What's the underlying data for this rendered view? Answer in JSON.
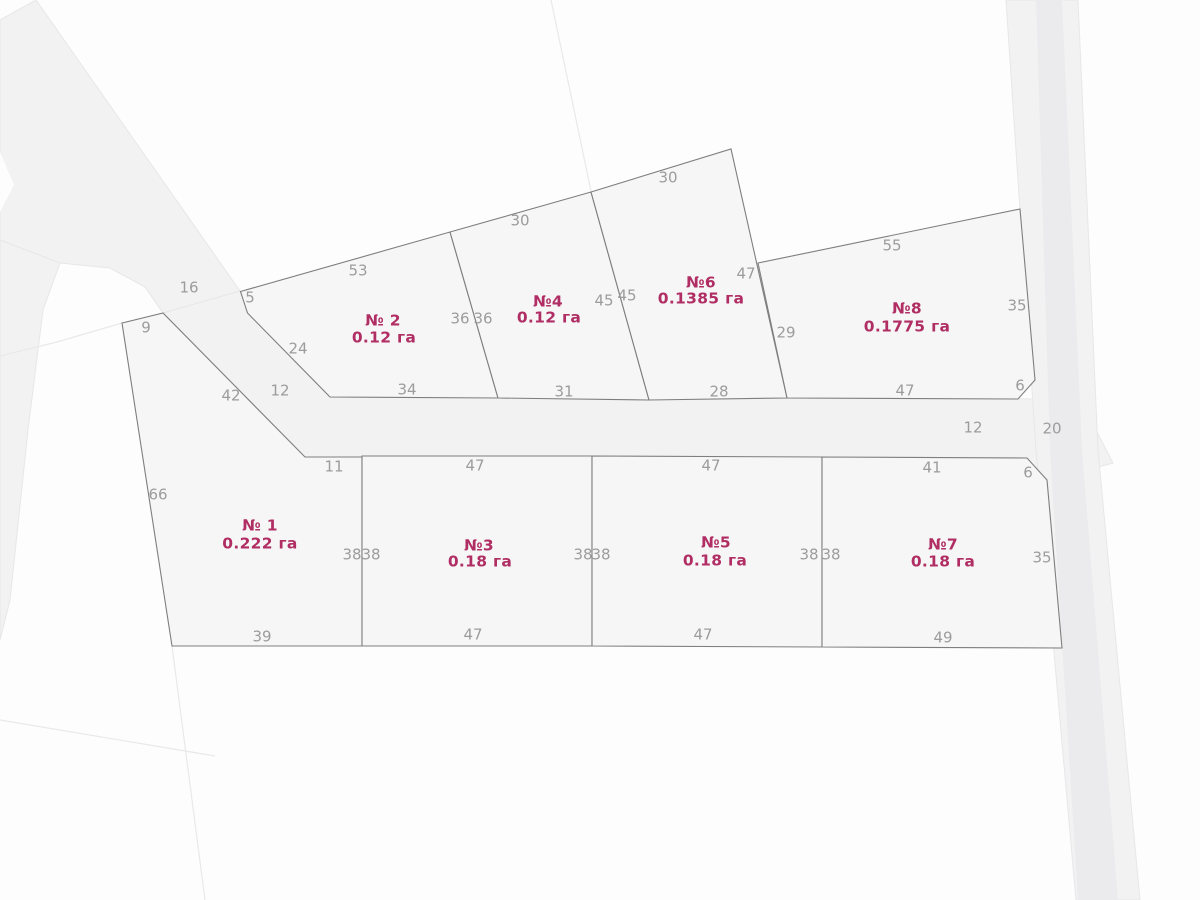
{
  "canvas": {
    "width": 1200,
    "height": 900
  },
  "colors": {
    "page": "#fdfdfd",
    "road_fill": "#f2f2f3",
    "road_stroke": "#e7e7e9",
    "road_inner_fill": "#ebebed",
    "plot_fill": "#f6f6f7",
    "plot_stroke": "#7e7e7e",
    "faint_line": "#e9e9eb",
    "edge_label": "#9c9c9c",
    "plot_label": "#b02e63"
  },
  "roads": [
    {
      "name": "road-northwest-diagonal",
      "points": [
        [
          36,
          0
        ],
        [
          240,
          291
        ],
        [
          163,
          313
        ],
        [
          145,
          287
        ],
        [
          110,
          268
        ],
        [
          60,
          263
        ],
        [
          0,
          240
        ],
        [
          0,
          20
        ]
      ]
    },
    {
      "name": "road-west-branch",
      "points": [
        [
          0,
          240
        ],
        [
          60,
          263
        ],
        [
          43,
          310
        ],
        [
          28,
          430
        ],
        [
          10,
          600
        ],
        [
          0,
          640
        ]
      ]
    },
    {
      "name": "road-central-horizontal",
      "points": [
        [
          240,
          291
        ],
        [
          248,
          313
        ],
        [
          330,
          397
        ],
        [
          1080,
          399
        ],
        [
          1113,
          463
        ],
        [
          1047,
          481
        ],
        [
          1027,
          458
        ],
        [
          362,
          457
        ],
        [
          305,
          457
        ],
        [
          163,
          313
        ]
      ]
    },
    {
      "name": "road-east-vertical",
      "points": [
        [
          1006,
          0
        ],
        [
          1078,
          0
        ],
        [
          1098,
          450
        ],
        [
          1140,
          900
        ],
        [
          1076,
          900
        ],
        [
          1036,
          450
        ]
      ]
    }
  ],
  "road_inner_strips": [
    {
      "name": "road-east-inner-strip",
      "points": [
        [
          1036,
          0
        ],
        [
          1062,
          0
        ],
        [
          1082,
          450
        ],
        [
          1118,
          900
        ],
        [
          1078,
          900
        ],
        [
          1050,
          450
        ]
      ]
    }
  ],
  "road_medians": [
    {
      "name": "road-median-island",
      "points": [
        [
          0,
          152
        ],
        [
          14,
          185
        ],
        [
          0,
          212
        ]
      ]
    }
  ],
  "boundary_lines": [
    {
      "name": "faint-boundary-north",
      "points": [
        [
          551,
          0
        ],
        [
          591,
          191
        ]
      ]
    },
    {
      "name": "faint-boundary-southwest-diagonal",
      "points": [
        [
          0,
          720
        ],
        [
          215,
          756
        ]
      ]
    },
    {
      "name": "faint-boundary-south-vertical",
      "points": [
        [
          172,
          646
        ],
        [
          205,
          900
        ]
      ]
    },
    {
      "name": "faint-boundary-west",
      "points": [
        [
          122,
          323
        ],
        [
          57,
          342
        ],
        [
          0,
          356
        ]
      ]
    }
  ],
  "plots": [
    {
      "id": "1",
      "number": "№ 1",
      "area": "0.222 га",
      "number_pos": [
        260,
        526
      ],
      "area_pos": [
        260,
        544
      ],
      "points": [
        [
          122,
          323
        ],
        [
          163,
          313
        ],
        [
          305,
          457
        ],
        [
          362,
          457
        ],
        [
          362,
          646
        ],
        [
          172,
          646
        ]
      ]
    },
    {
      "id": "2",
      "number": "№ 2",
      "area": "0.12 га",
      "number_pos": [
        383,
        321
      ],
      "area_pos": [
        384,
        338
      ],
      "points": [
        [
          240.5,
          291.5
        ],
        [
          450,
          232
        ],
        [
          498,
          398
        ],
        [
          330,
          397
        ],
        [
          247.5,
          313
        ]
      ]
    },
    {
      "id": "3",
      "number": "№3",
      "area": "0.18 га",
      "number_pos": [
        479,
        546
      ],
      "area_pos": [
        480,
        562
      ],
      "points": [
        [
          362,
          456
        ],
        [
          592,
          456
        ],
        [
          592,
          646
        ],
        [
          362,
          646
        ]
      ]
    },
    {
      "id": "4",
      "number": "№4",
      "area": "0.12 га",
      "number_pos": [
        548,
        302
      ],
      "area_pos": [
        549,
        318
      ],
      "points": [
        [
          450,
          232
        ],
        [
          591,
          192
        ],
        [
          649,
          400
        ],
        [
          498,
          398
        ]
      ]
    },
    {
      "id": "5",
      "number": "№5",
      "area": "0.18 га",
      "number_pos": [
        716,
        543
      ],
      "area_pos": [
        715,
        561
      ],
      "points": [
        [
          592,
          456
        ],
        [
          822,
          457
        ],
        [
          822,
          647
        ],
        [
          592,
          646
        ]
      ]
    },
    {
      "id": "6",
      "number": "№6",
      "area": "0.1385 га",
      "number_pos": [
        701,
        283
      ],
      "area_pos": [
        701,
        299
      ],
      "points": [
        [
          591,
          192
        ],
        [
          731,
          149
        ],
        [
          787,
          398
        ],
        [
          649,
          400
        ]
      ]
    },
    {
      "id": "7",
      "number": "№7",
      "area": "0.18 га",
      "number_pos": [
        943,
        545
      ],
      "area_pos": [
        943,
        562
      ],
      "points": [
        [
          822,
          457
        ],
        [
          1027,
          458
        ],
        [
          1047,
          480
        ],
        [
          1062,
          648
        ],
        [
          822,
          647
        ]
      ]
    },
    {
      "id": "8",
      "number": "№8",
      "area": "0.1775 га",
      "number_pos": [
        907,
        309
      ],
      "area_pos": [
        907,
        327
      ],
      "points": [
        [
          758,
          263
        ],
        [
          1020,
          209
        ],
        [
          1035,
          380
        ],
        [
          1018,
          399
        ],
        [
          787,
          398
        ]
      ]
    }
  ],
  "edge_labels": [
    {
      "text": "16",
      "x": 189,
      "y": 288
    },
    {
      "text": "9",
      "x": 146,
      "y": 328
    },
    {
      "text": "5",
      "x": 250,
      "y": 298
    },
    {
      "text": "53",
      "x": 358,
      "y": 271
    },
    {
      "text": "24",
      "x": 298,
      "y": 349
    },
    {
      "text": "42",
      "x": 231,
      "y": 396
    },
    {
      "text": "12",
      "x": 280,
      "y": 391
    },
    {
      "text": "34",
      "x": 407,
      "y": 390
    },
    {
      "text": "36",
      "x": 460,
      "y": 319
    },
    {
      "text": "36",
      "x": 483,
      "y": 319
    },
    {
      "text": "30",
      "x": 520,
      "y": 221
    },
    {
      "text": "31",
      "x": 564,
      "y": 392
    },
    {
      "text": "45",
      "x": 604,
      "y": 301
    },
    {
      "text": "45",
      "x": 627,
      "y": 296
    },
    {
      "text": "30",
      "x": 668,
      "y": 178
    },
    {
      "text": "28",
      "x": 719,
      "y": 392
    },
    {
      "text": "47",
      "x": 746,
      "y": 274
    },
    {
      "text": "29",
      "x": 786,
      "y": 333
    },
    {
      "text": "55",
      "x": 892,
      "y": 246
    },
    {
      "text": "35",
      "x": 1017,
      "y": 306
    },
    {
      "text": "6",
      "x": 1020,
      "y": 386
    },
    {
      "text": "47",
      "x": 905,
      "y": 391
    },
    {
      "text": "12",
      "x": 973,
      "y": 428
    },
    {
      "text": "20",
      "x": 1052,
      "y": 429
    },
    {
      "text": "11",
      "x": 334,
      "y": 467
    },
    {
      "text": "47",
      "x": 475,
      "y": 466
    },
    {
      "text": "47",
      "x": 711,
      "y": 466
    },
    {
      "text": "41",
      "x": 932,
      "y": 468
    },
    {
      "text": "6",
      "x": 1028,
      "y": 473
    },
    {
      "text": "66",
      "x": 158,
      "y": 495
    },
    {
      "text": "38",
      "x": 352,
      "y": 555
    },
    {
      "text": "38",
      "x": 371,
      "y": 555
    },
    {
      "text": "38",
      "x": 583,
      "y": 555
    },
    {
      "text": "38",
      "x": 601,
      "y": 555
    },
    {
      "text": "38",
      "x": 809,
      "y": 555
    },
    {
      "text": "38",
      "x": 831,
      "y": 555
    },
    {
      "text": "35",
      "x": 1042,
      "y": 558
    },
    {
      "text": "39",
      "x": 262,
      "y": 637
    },
    {
      "text": "47",
      "x": 473,
      "y": 635
    },
    {
      "text": "47",
      "x": 703,
      "y": 635
    },
    {
      "text": "49",
      "x": 943,
      "y": 638
    }
  ]
}
